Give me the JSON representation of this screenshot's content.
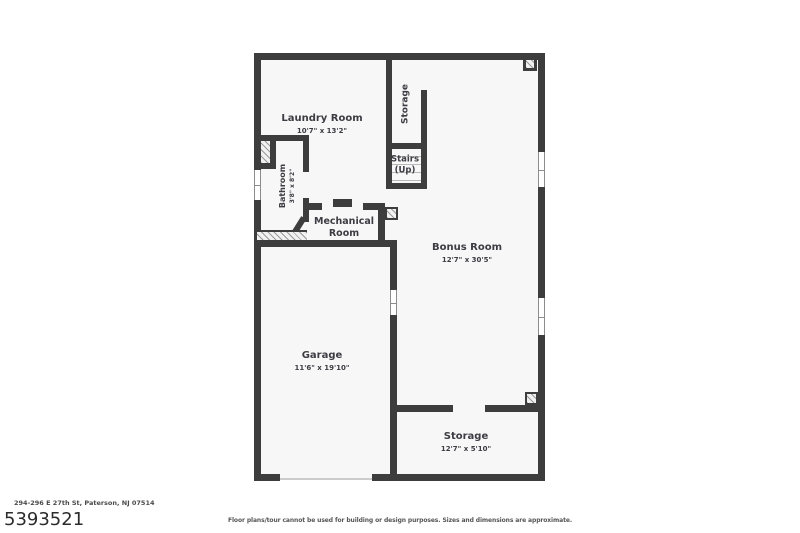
{
  "plan": {
    "colors": {
      "wall": "#3d3d3d",
      "floor": "#f7f7f7",
      "hatch_line": "#9a9a9a"
    },
    "rooms": {
      "laundry": {
        "name": "Laundry Room",
        "dims": "10'7\" x 13'2\""
      },
      "storage_top": {
        "name": "Storage"
      },
      "stairs": {
        "line1": "Stairs",
        "line2": "(Up)"
      },
      "bathroom": {
        "name": "Bathroom",
        "dims": "3'8\" x 8'2\""
      },
      "mechanical": {
        "line1": "Mechanical",
        "line2": "Room"
      },
      "bonus": {
        "name": "Bonus Room",
        "dims": "12'7\" x 30'5\""
      },
      "garage": {
        "name": "Garage",
        "dims": "11'6\" x 19'10\""
      },
      "storage_bottom": {
        "name": "Storage",
        "dims": "12'7\" x 5'10\""
      }
    }
  },
  "footer": {
    "address": "294-296 E 27th St, Paterson, NJ 07514",
    "listing_id": "5393521",
    "disclaimer": "Floor plans/tour cannot be used for building or design purposes. Sizes and dimensions are approximate."
  }
}
